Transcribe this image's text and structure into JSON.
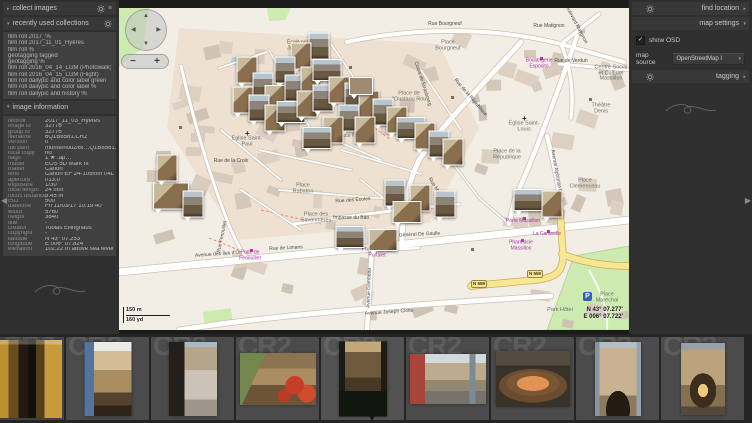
{
  "icons": {
    "expanded": "▾",
    "collapsed": "▸",
    "menu": "≡",
    "check": "✓",
    "dropdown": "▾",
    "collapse_left": "◀",
    "collapse_right": "▶",
    "collapse_down": "▼",
    "nav_up": "▲",
    "nav_down": "▼",
    "nav_left": "◀",
    "nav_right": "▶"
  },
  "left_panel": {
    "collect_images": {
      "label": "collect images"
    },
    "recently_used_collections": {
      "label": "recently used collections",
      "items": [
        "film roll 2017_%",
        "film roll 2017_11_01_Hyères",
        "film roll %",
        "geotagging tagged",
        "geotagging %",
        "film roll 2016_04_14_LGM (Photowalk)",
        "film roll 2016_04_15_LGM (Flight)",
        "film roll dailypic and color label green",
        "film roll dailypic and color label %",
        "film roll dailypic and history %"
      ]
    },
    "image_information": {
      "label": "image information",
      "fields": [
        {
          "label": "filmroll",
          "value": "2017_11_03_Hyères"
        },
        {
          "label": "image id",
          "value": "32776"
        },
        {
          "label": "group id",
          "value": "32776"
        },
        {
          "label": "filename",
          "value": "6Q1B8581.CR2"
        },
        {
          "label": "version",
          "value": "0"
        },
        {
          "label": "full path",
          "value": "/home/houz/Bi…Q1B8581.CR2"
        },
        {
          "label": "local copy",
          "value": "no"
        },
        {
          "label": "flags",
          "value": "1 ★ .ap…"
        },
        {
          "label": "model",
          "value": "EOS 5D Mark III"
        },
        {
          "label": "maker",
          "value": "Canon"
        },
        {
          "label": "lens",
          "value": "Canon EF 24-105mm f/4L IS"
        },
        {
          "label": "aperture",
          "value": "f/13.0"
        },
        {
          "label": "exposure",
          "value": "1/30"
        },
        {
          "label": "focal length",
          "value": "24 mm"
        },
        {
          "label": "focus distance",
          "value": "3.45 m"
        },
        {
          "label": "ISO",
          "value": "500"
        },
        {
          "label": "datetime",
          "value": "Fri 11/03/17 10:19:40"
        },
        {
          "label": "width",
          "value": "5760"
        },
        {
          "label": "height",
          "value": "3840"
        },
        {
          "label": "title",
          "value": "-"
        },
        {
          "label": "creator",
          "value": "Tobias Ellinghaus"
        },
        {
          "label": "copyright",
          "value": "-"
        },
        {
          "label": "latitude",
          "value": "N 43° 07.253'"
        },
        {
          "label": "longitude",
          "value": "E 006° 07.824'"
        },
        {
          "label": "elevation",
          "value": "102.22 m above sea level"
        }
      ]
    }
  },
  "right_panel": {
    "find_location": {
      "label": "find location"
    },
    "map_settings": {
      "label": "map settings",
      "show_osd_label": "show OSD",
      "show_osd_checked": true,
      "map_source_label": "map source",
      "map_source_value": "OpenStreetMap I"
    },
    "tagging": {
      "label": "tagging"
    }
  },
  "map": {
    "osd": {
      "zoom_in_label": "+",
      "zoom_out_label": "−"
    },
    "scale": {
      "metric": "150 m",
      "imperial": "160 yd"
    },
    "cursor_coordinates": {
      "latitude": "N 43° 07.277'",
      "longitude": "E 006° 07.722'"
    },
    "road_ref": "N 559",
    "parking_label": "P",
    "labels": [
      "Place Massillon",
      "Place de la République",
      "Place Clemenceau",
      "Église Saint-Louis",
      "Théâtre Denis",
      "Place de l'Oustaou Rou",
      "Rue Bourgneuf",
      "Place Bourgneuf",
      "Rue Matignon",
      "Boulevard Matignon",
      "Boulangerie Esposito",
      "Rue de Verdun",
      "Centre Social et Culturel Massillon",
      "Rue de Limans",
      "Avenue des Îles d'Or",
      "Avenue du Général De Gaulle",
      "Avenue Joseph Clotis",
      "Avenue Gambetta",
      "Place des Savonnières",
      "Rue des Écoles",
      "Rue Fenouillet",
      "Porte de Fenouillet",
      "Rue de la Croix",
      "Place Rabaton",
      "Impasse du Bâti",
      "Rue Massillon",
      "Porte Massillon",
      "Pharmacie Massillon",
      "Pharmacie du Portalet",
      "La Caravelle",
      "Park Hôtel",
      "Place Maréchal",
      "Avenue Alphonse Denis",
      "École primaire Jules Michelet",
      "Place de l'Oratoire",
      "Église Saint-Paul",
      "Cours de Strasbourg",
      "Rue de la République"
    ]
  },
  "filmstrip": {
    "extension_watermark": "CR2",
    "photo_count": 9
  }
}
